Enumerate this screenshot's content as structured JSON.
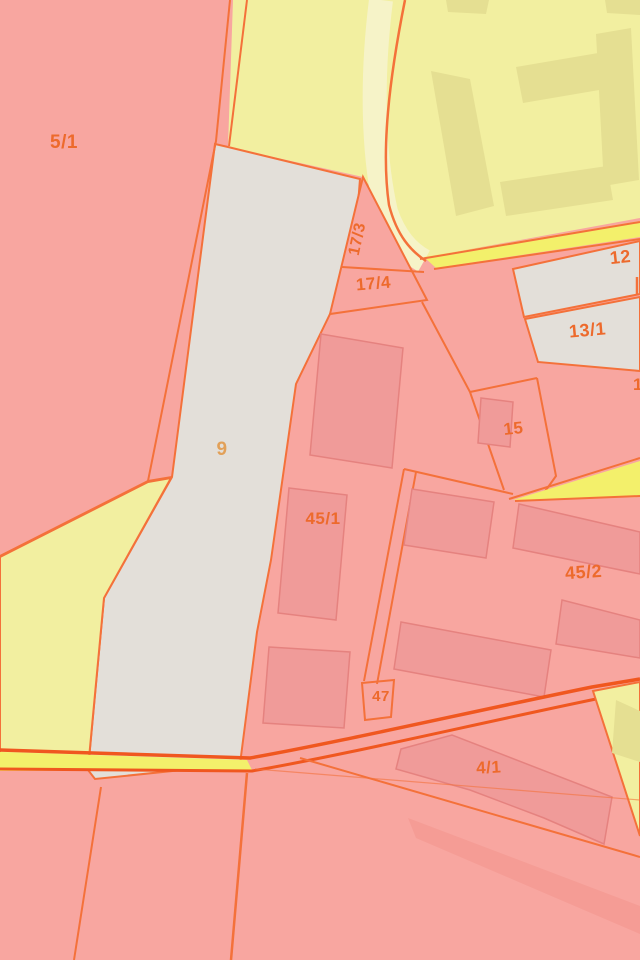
{
  "map": {
    "kind": "cadastral-parcel-map-tile",
    "labels": [
      {
        "id": "5-1",
        "text": "5/1"
      },
      {
        "id": "17-3",
        "text": "17/3"
      },
      {
        "id": "17-4",
        "text": "17/4"
      },
      {
        "id": "12",
        "text": "12"
      },
      {
        "id": "13-1",
        "text": "13/1"
      },
      {
        "id": "15",
        "text": "15"
      },
      {
        "id": "9",
        "text": "9"
      },
      {
        "id": "45-1",
        "text": "45/1"
      },
      {
        "id": "45-2",
        "text": "45/2"
      },
      {
        "id": "47",
        "text": "47"
      },
      {
        "id": "4-1",
        "text": "4/1"
      },
      {
        "id": "edge-partial",
        "text": "1"
      }
    ],
    "palette": {
      "parcel_pink": "#f8a6a0",
      "parcel_gray": "#e3dfd9",
      "parcel_yellow": "#f2efa0",
      "road_yellow": "#f3f06b",
      "pale_verge": "#f6f3c8",
      "building_pink": "#f09b99",
      "building_pink_stroke": "#e5827f",
      "building_yellow": "#e5df92",
      "boundary_orange": "#f4713a",
      "road_orange": "#f0571f",
      "label_orange": "#ed6a2c",
      "label_muted": "#e2a058"
    }
  }
}
